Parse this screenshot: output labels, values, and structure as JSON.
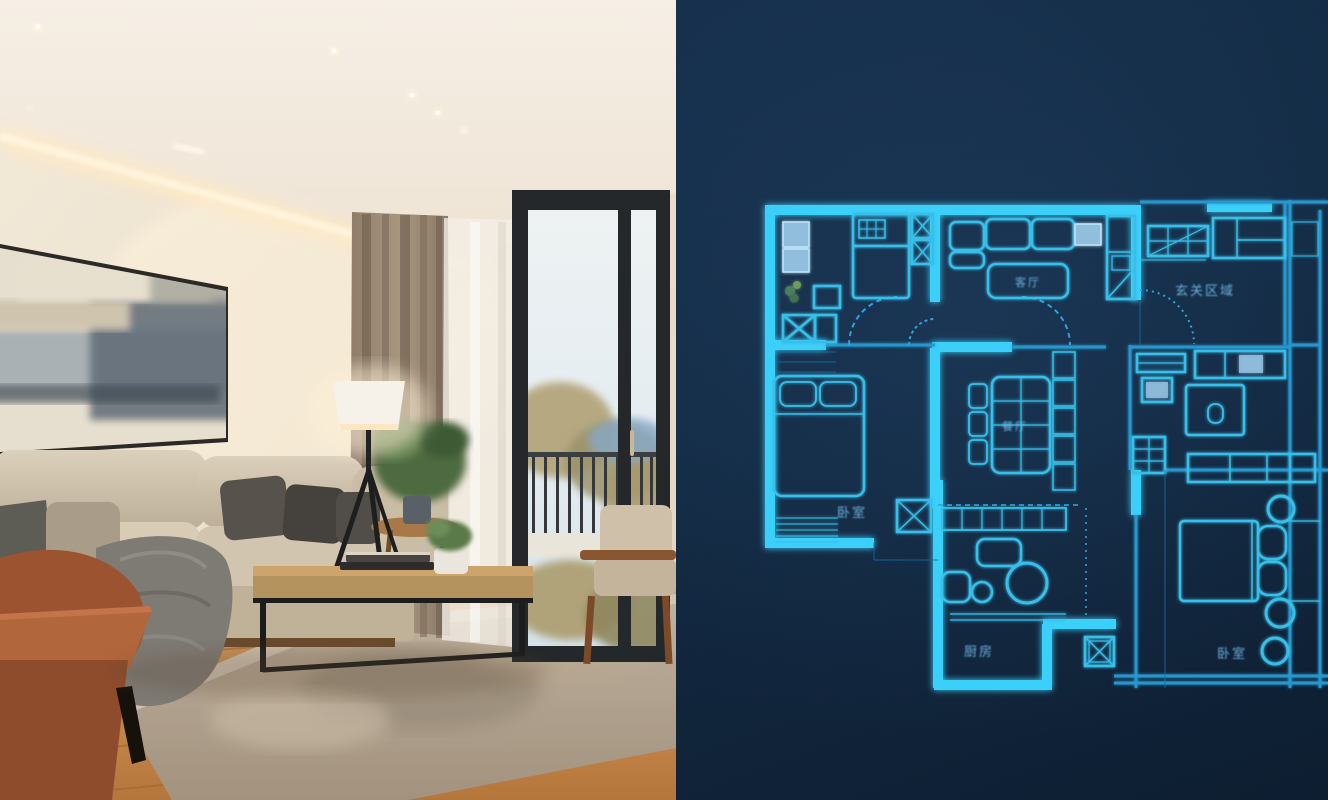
{
  "scene": {
    "left_panel_type": "interior-photo",
    "right_panel_type": "blueprint-floor-plan"
  },
  "floorplan": {
    "labels": {
      "living_room": "客厅",
      "entry_area": "玄关区域",
      "dining": "餐厅",
      "bedroom_left": "卧室",
      "kitchen": "厨房",
      "bedroom_right": "卧室"
    }
  },
  "colors": {
    "blueprint_background": "#132a43",
    "wall_bright": "#3bd0fa",
    "line_medium": "#2596cc",
    "line_dim": "#1a6fa3",
    "window_fill": "#92bede",
    "label_text": "#6fb9e2",
    "photo_wall": "#ede2d2",
    "cove_light": "#ffe9c4",
    "sofa_fabric": "#cfc3ae",
    "accent_chair": "#9c5430",
    "wood_floor": "#c98d4e",
    "curtain": "#9a8875",
    "window_frame": "#24282b"
  }
}
